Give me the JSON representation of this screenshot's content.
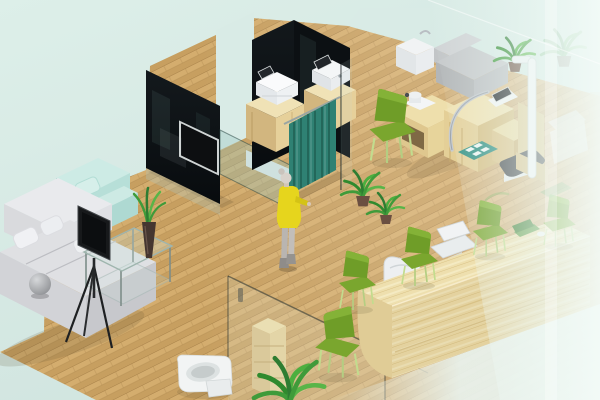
{
  "scene": {
    "kind": "isometric-3d-interior-render",
    "areas": {
      "lounge": "sofa lounge with TV easel and glass coffee table",
      "exam_rooms": "partitioned rooms with printer cabinets and teal curtain",
      "measurement_corner": "wooden workstation with exam couch, height rod, scale and foot mat",
      "reception": "long wooden counter with white chairs and green visitor chairs",
      "bathroom": "glass enclosure with toilet and shelf unit"
    }
  },
  "palette": {
    "background_top": "#ddefe9",
    "background_bottom": "#cfe3de",
    "floor_wood": "#cda466",
    "floor_wood_dark": "#c79f60",
    "floor_line": "#a8824a",
    "wall_glass_black": "#0c1013",
    "partition_glass": "#a8ccc6",
    "curtain_teal": "#2f8173",
    "furniture_wood": "#e6d09a",
    "furniture_wood_dark": "#d2b67f",
    "counter_wood": "#e0cc96",
    "sofa_gray": "#dfe0e3",
    "armchair_mint": "#b7dfd8",
    "chair_green": "#6f9d28",
    "chair_green_legs": "#c2dc8e",
    "person_dress_yellow": "#e6d51d",
    "plant_green": "#3f9b3a",
    "device_white": "#f2f4f6",
    "exam_couch_gray": "#c6c9cb",
    "scale_dark": "#44484c",
    "mat_teal": "#2e8f82",
    "haze_white": "#ecf7f3",
    "tv_black": "#0d0f11"
  },
  "objects": {
    "lounge_sofa": "L-shaped light gray fabric sofa with pillows",
    "armchair": "Mint green armchair with pillow",
    "display_easel": "Dark flat panel on black tripod easel",
    "ball_lamp": "Gray sphere lamp on sofa arm",
    "coffee_table": "Glass coffee table",
    "table_plant": "Spiky plant in dark vase",
    "wall_tv": "TV mounted on black glass partition",
    "printer_station_1": "Wood cabinet with white printer and small display",
    "printer_station_2": "Wood cabinet with white device and screen",
    "privacy_curtain": "Teal pleated privacy curtain on rail",
    "person": "Standing woman in yellow dress and gray boots",
    "floor_plants": "Two potted leafy plants by the curtain",
    "exam_desk": "Curved wooden examination workstation with chrome handle",
    "exam_couch": "Gray examination couch",
    "white_cabinet": "Small white cabinet with faucet",
    "height_rod": "White height measuring stand on wood base",
    "weight_scale": "Dark floor weight scale",
    "foot_mat": "Teal mat with four white pads",
    "guest_chairs": "Green visitor chairs with thin legs",
    "reception_counter": "Long rounded wooden reception counter",
    "reception_chairs": "White molded office chairs",
    "reception_laptop": "Green laptop with white mouse on counter",
    "bathroom_glass": "Glass bathroom enclosure panels",
    "toilet": "White toilet",
    "bath_shelf": "Wooden shelf unit behind glass",
    "bathroom_plant": "Leafy plant at bathroom front",
    "foreground_glass": "Large semi-transparent glass pane washing out the right side"
  }
}
